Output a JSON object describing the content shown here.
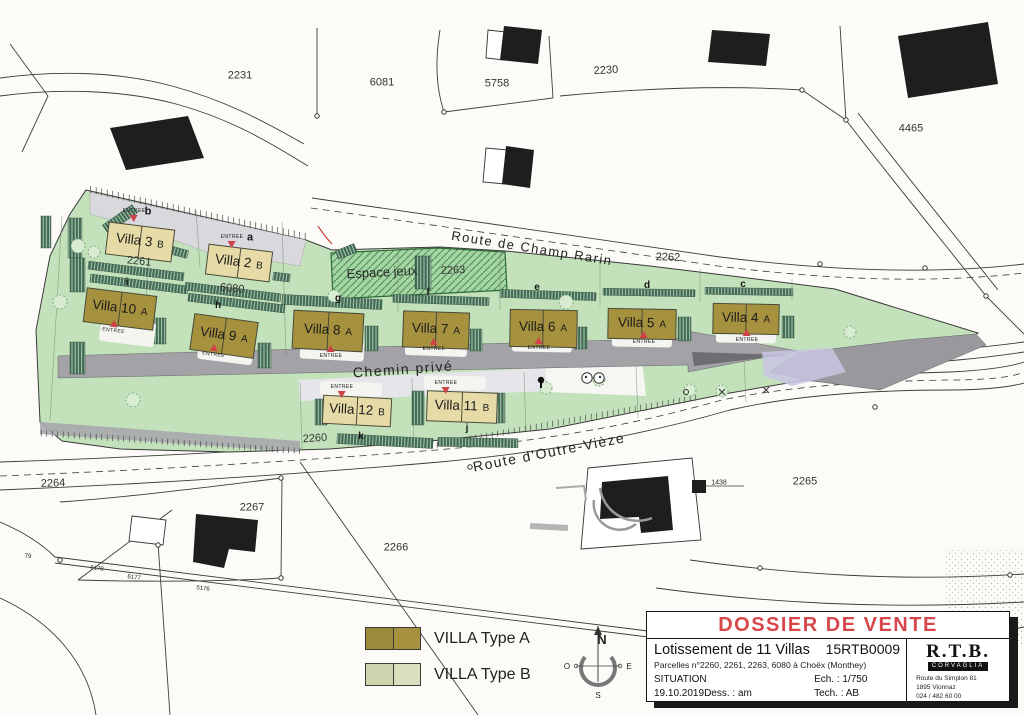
{
  "map": {
    "roads": {
      "champ_rarin": "Route de Champ Rarin",
      "chemin_prive": "Chemin privé",
      "outre_vieze": "Route d'Outre-Vièze"
    },
    "espace_jeux": "Espace jeux",
    "entree": "ENTREE",
    "villas": [
      {
        "name": "Villa 3",
        "type": "B"
      },
      {
        "name": "Villa 2",
        "type": "B"
      },
      {
        "name": "Villa 10",
        "type": "A"
      },
      {
        "name": "Villa 9",
        "type": "A"
      },
      {
        "name": "Villa 8",
        "type": "A"
      },
      {
        "name": "Villa 7",
        "type": "A"
      },
      {
        "name": "Villa 6",
        "type": "A"
      },
      {
        "name": "Villa 5",
        "type": "A"
      },
      {
        "name": "Villa 4",
        "type": "A"
      },
      {
        "name": "Villa 12",
        "type": "B"
      },
      {
        "name": "Villa 11",
        "type": "B"
      }
    ],
    "letters": {
      "a": "a",
      "b": "b",
      "c": "c",
      "d": "d",
      "e": "e",
      "f": "f",
      "g": "g",
      "h": "h",
      "i": "i",
      "j": "j",
      "k": "k"
    },
    "parcels": {
      "p2231": "2231",
      "p6081": "6081",
      "p5758": "5758",
      "p2230": "2230",
      "p4465": "4465",
      "p2261": "2261",
      "p6080": "6080",
      "p2263": "2263",
      "p2262": "2262",
      "p2260": "2260",
      "p2264": "2264",
      "p2267": "2267",
      "p2266": "2266",
      "p2265": "2265",
      "p1438": "1438",
      "p79": "79",
      "p5178": "5178",
      "p6177": "6177",
      "p5176": "5176"
    }
  },
  "legend": {
    "type_a": "VILLA Type A",
    "type_b": "VILLA Type B"
  },
  "compass": {
    "n": "N",
    "s": "S",
    "e": "E",
    "o": "O"
  },
  "title_block": {
    "title": "DOSSIER DE VENTE",
    "project": "Lotissement de 11 Villas",
    "doc_number": "15RTB0009",
    "parcels_line": "Parcelles n°2260, 2261, 2263, 6080 à Choëx (Monthey)",
    "phase": "SITUATION",
    "date": "19.10.2019",
    "dess": "Dess. : am",
    "ech": "Ech. : 1/750",
    "tech": "Tech. : AB",
    "company": "R.T.B.",
    "company_bar": "CORVAGLIA",
    "address1": "Route du Simplon 81",
    "address2": "1895 Vionnaz",
    "phone": "024 / 482 60 00"
  },
  "colors": {
    "villa_type_a": "#a6913f",
    "villa_type_b": "#e6daa6",
    "site_green": "#c3e2bb",
    "road_gray": "#a2a2a7",
    "accent_red": "#cf4348",
    "title_red": "#d8474c"
  }
}
